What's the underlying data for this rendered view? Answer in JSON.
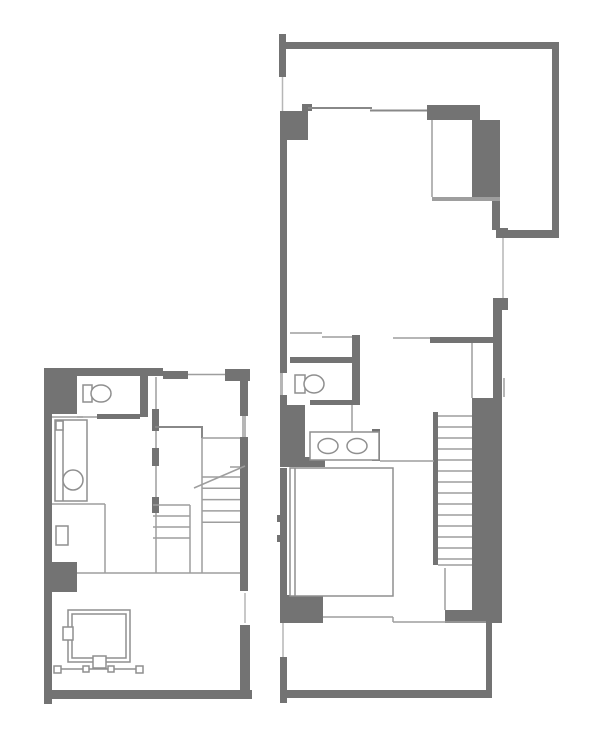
{
  "canvas": {
    "width": 600,
    "height": 746,
    "background": "#ffffff"
  },
  "palette": {
    "wall": "#737373",
    "line_dark": "#888888",
    "line": "#9e9e9e",
    "line_light": "#b6b6b6",
    "fixture": "#8f8f8f",
    "white": "#ffffff"
  },
  "plans": [
    {
      "name": "floor-plan-left",
      "shapes": [
        {
          "t": "r",
          "x": 44,
          "y": 368,
          "w": 119,
          "h": 8,
          "name": "wall-top"
        },
        {
          "t": "r",
          "x": 163,
          "y": 371,
          "w": 25,
          "h": 8,
          "name": "wall-top-step"
        },
        {
          "t": "r",
          "x": 225,
          "y": 369,
          "w": 25,
          "h": 12,
          "name": "wall-top-right-block"
        },
        {
          "t": "r",
          "x": 44,
          "y": 368,
          "w": 33,
          "h": 46,
          "name": "wall-left-block"
        },
        {
          "t": "r",
          "x": 44,
          "y": 414,
          "w": 8,
          "h": 148,
          "name": "wall-left"
        },
        {
          "t": "r",
          "x": 44,
          "y": 562,
          "w": 33,
          "h": 30,
          "name": "wall-left-pier"
        },
        {
          "t": "r",
          "x": 44,
          "y": 592,
          "w": 8,
          "h": 107,
          "name": "wall-left-lower"
        },
        {
          "t": "r",
          "x": 44,
          "y": 690,
          "w": 208,
          "h": 9,
          "name": "wall-bottom"
        },
        {
          "t": "r",
          "x": 44,
          "y": 699,
          "w": 8,
          "h": 5,
          "name": "wall-bottom-stub"
        },
        {
          "t": "r",
          "x": 240,
          "y": 381,
          "w": 8,
          "h": 35,
          "name": "wall-right-upper"
        },
        {
          "t": "r",
          "x": 242,
          "y": 416,
          "w": 4,
          "h": 21,
          "c": "line_light",
          "name": "window-right-upper"
        },
        {
          "t": "r",
          "x": 240,
          "y": 437,
          "w": 8,
          "h": 154,
          "name": "wall-right-mid"
        },
        {
          "t": "r",
          "x": 240,
          "y": 625,
          "w": 10,
          "h": 66,
          "name": "wall-right-lower"
        },
        {
          "t": "r",
          "x": 140,
          "y": 374,
          "w": 8,
          "h": 43,
          "name": "wall-toilet-right"
        },
        {
          "t": "r",
          "x": 97,
          "y": 414,
          "w": 43,
          "h": 5,
          "name": "wall-toilet-bottom"
        },
        {
          "t": "r",
          "x": 152,
          "y": 409,
          "w": 7,
          "h": 22,
          "name": "wall-middle-seg1"
        },
        {
          "t": "r",
          "x": 152,
          "y": 448,
          "w": 7,
          "h": 18,
          "name": "wall-middle-seg2"
        },
        {
          "t": "r",
          "x": 152,
          "y": 497,
          "w": 7,
          "h": 16,
          "name": "wall-middle-seg3"
        },
        {
          "t": "or",
          "x": 55,
          "y": 420,
          "w": 32,
          "h": 81,
          "name": "kitchen-counter"
        },
        {
          "t": "l",
          "x1": 63,
          "y1": 420,
          "x2": 63,
          "y2": 501,
          "c": "fixture",
          "name": "kitchen-counter-edge"
        },
        {
          "t": "or",
          "x": 56,
          "y": 421,
          "w": 7,
          "h": 9,
          "name": "faucet-box"
        },
        {
          "t": "c",
          "cx": 73,
          "cy": 480,
          "r": 10,
          "name": "kitchen-sink"
        },
        {
          "t": "or",
          "x": 56,
          "y": 526,
          "w": 12,
          "h": 19,
          "name": "side-box"
        },
        {
          "t": "or",
          "x": 83,
          "y": 385,
          "w": 9,
          "h": 17,
          "name": "toilet-tank"
        },
        {
          "t": "e",
          "cx": 101,
          "cy": 393.5,
          "rx": 10,
          "ry": 8.5,
          "name": "toilet-bowl"
        },
        {
          "t": "or",
          "x": 68,
          "y": 610,
          "w": 62,
          "h": 52,
          "name": "low-table-outer"
        },
        {
          "t": "or",
          "x": 72,
          "y": 614,
          "w": 54,
          "h": 44,
          "name": "low-table-inner"
        },
        {
          "t": "or",
          "x": 63,
          "y": 627,
          "w": 10,
          "h": 13,
          "name": "side-attachment-box"
        },
        {
          "t": "or",
          "x": 93,
          "y": 656,
          "w": 13,
          "h": 12,
          "name": "bottom-attachment-box"
        },
        {
          "t": "l",
          "x1": 57,
          "y1": 669,
          "x2": 140,
          "y2": 669,
          "c": "fixture",
          "name": "rail-line"
        },
        {
          "t": "or",
          "x": 54,
          "y": 666,
          "w": 7,
          "h": 7,
          "name": "rail-post"
        },
        {
          "t": "or",
          "x": 83,
          "y": 666,
          "w": 6,
          "h": 6,
          "name": "rail-post"
        },
        {
          "t": "or",
          "x": 108,
          "y": 666,
          "w": 6,
          "h": 6,
          "name": "rail-post"
        },
        {
          "t": "or",
          "x": 136,
          "y": 666,
          "w": 7,
          "h": 7,
          "name": "rail-post"
        },
        {
          "t": "l",
          "x1": 188,
          "y1": 374.5,
          "x2": 225,
          "y2": 374.5,
          "name": "window-top"
        },
        {
          "t": "l",
          "x1": 77,
          "y1": 417,
          "x2": 97,
          "y2": 417,
          "name": "toilet-door-line"
        },
        {
          "t": "l",
          "x1": 52,
          "y1": 417,
          "x2": 83,
          "y2": 417,
          "name": "counter-top-line"
        },
        {
          "t": "l",
          "x1": 156,
          "y1": 377,
          "x2": 156,
          "y2": 409,
          "name": "partition-line"
        },
        {
          "t": "l",
          "x1": 156,
          "y1": 431,
          "x2": 156,
          "y2": 448,
          "name": "partition-line"
        },
        {
          "t": "l",
          "x1": 156,
          "y1": 466,
          "x2": 156,
          "y2": 497,
          "name": "partition-line"
        },
        {
          "t": "l",
          "x1": 156,
          "y1": 513,
          "x2": 156,
          "y2": 573,
          "name": "partition-line"
        },
        {
          "t": "l",
          "x1": 155,
          "y1": 427,
          "x2": 203,
          "y2": 427,
          "sw": 2,
          "c": "line_dark",
          "name": "hall-partition"
        },
        {
          "t": "l",
          "x1": 202,
          "y1": 427,
          "x2": 202,
          "y2": 438,
          "sw": 2,
          "c": "line_dark",
          "name": "hall-partition"
        },
        {
          "t": "l",
          "x1": 202,
          "y1": 438,
          "x2": 240,
          "y2": 438,
          "name": "hall-partition-light"
        },
        {
          "t": "l",
          "x1": 52,
          "y1": 504,
          "x2": 105,
          "y2": 504,
          "name": "kitchen-floor-line"
        },
        {
          "t": "l",
          "x1": 105,
          "y1": 504,
          "x2": 105,
          "y2": 573,
          "name": "kitchen-floor-line"
        },
        {
          "t": "l",
          "x1": 77,
          "y1": 573,
          "x2": 240,
          "y2": 573,
          "name": "room-divider-line"
        },
        {
          "t": "l",
          "x1": 245,
          "y1": 593,
          "x2": 245,
          "y2": 623,
          "c": "line_light",
          "name": "window-right-lower"
        },
        {
          "t": "l",
          "x1": 190,
          "y1": 505,
          "x2": 190,
          "y2": 573,
          "name": "stair-stringer"
        },
        {
          "t": "l",
          "x1": 202,
          "y1": 438,
          "x2": 202,
          "y2": 573,
          "name": "stair-stringer"
        },
        {
          "t": "tr",
          "x1": 153,
          "x2": 190,
          "y0": 505,
          "step": 11,
          "n": 4,
          "name": "stair-treads"
        },
        {
          "t": "tr",
          "x1": 202,
          "x2": 240,
          "y0": 477,
          "step": 11.3,
          "n": 5,
          "name": "stair-treads"
        },
        {
          "t": "l",
          "x1": 230,
          "y1": 467,
          "x2": 240,
          "y2": 467,
          "name": "stair-tread-partial"
        },
        {
          "t": "l",
          "x1": 194,
          "y1": 488,
          "x2": 245,
          "y2": 466,
          "name": "stair-break-line"
        }
      ]
    },
    {
      "name": "floor-plan-right",
      "shapes": [
        {
          "t": "r",
          "x": 279,
          "y": 34,
          "w": 7,
          "h": 43,
          "name": "wall-top-left-stub"
        },
        {
          "t": "r",
          "x": 286,
          "y": 42,
          "w": 273,
          "h": 7,
          "name": "wall-top"
        },
        {
          "t": "r",
          "x": 552,
          "y": 49,
          "w": 7,
          "h": 189,
          "name": "wall-right"
        },
        {
          "t": "r",
          "x": 508,
          "y": 230,
          "w": 51,
          "h": 8,
          "name": "wall-right-return"
        },
        {
          "t": "r",
          "x": 496,
          "y": 228,
          "w": 12,
          "h": 10,
          "name": "wall-stub"
        },
        {
          "t": "r",
          "x": 427,
          "y": 105,
          "w": 53,
          "h": 15,
          "name": "closet-top-wall"
        },
        {
          "t": "r",
          "x": 472,
          "y": 120,
          "w": 28,
          "h": 81,
          "name": "closet-right-wall"
        },
        {
          "t": "r",
          "x": 492,
          "y": 201,
          "w": 8,
          "h": 29,
          "name": "wall-column"
        },
        {
          "t": "r",
          "x": 302,
          "y": 104,
          "w": 10,
          "h": 7,
          "name": "wall-stub"
        },
        {
          "t": "r",
          "x": 280,
          "y": 111,
          "w": 28,
          "h": 29,
          "name": "wall-left-block"
        },
        {
          "t": "r",
          "x": 280,
          "y": 140,
          "w": 7,
          "h": 233,
          "name": "wall-left"
        },
        {
          "t": "r",
          "x": 280,
          "y": 373,
          "w": 3,
          "h": 22,
          "c": "line_light",
          "name": "window-left"
        },
        {
          "t": "r",
          "x": 280,
          "y": 395,
          "w": 7,
          "h": 10,
          "name": "wall-left"
        },
        {
          "t": "r",
          "x": 280,
          "y": 405,
          "w": 25,
          "h": 53,
          "name": "wall-left-pier"
        },
        {
          "t": "r",
          "x": 280,
          "y": 457,
          "w": 45,
          "h": 10,
          "name": "wall-stub-under-vanity"
        },
        {
          "t": "r",
          "x": 280,
          "y": 468,
          "w": 7,
          "h": 127,
          "name": "wall-left-lower"
        },
        {
          "t": "r",
          "x": 277,
          "y": 515,
          "w": 3,
          "h": 7,
          "name": "window-tick"
        },
        {
          "t": "r",
          "x": 277,
          "y": 535,
          "w": 3,
          "h": 7,
          "name": "window-tick"
        },
        {
          "t": "r",
          "x": 280,
          "y": 595,
          "w": 43,
          "h": 28,
          "name": "wall-bottom-left-pier"
        },
        {
          "t": "r",
          "x": 280,
          "y": 657,
          "w": 7,
          "h": 43,
          "name": "balcony-left-wall"
        },
        {
          "t": "r",
          "x": 282,
          "y": 690,
          "w": 210,
          "h": 8,
          "name": "balcony-bottom-wall"
        },
        {
          "t": "r",
          "x": 280,
          "y": 690,
          "w": 7,
          "h": 13,
          "name": "balcony-corner-stub"
        },
        {
          "t": "r",
          "x": 486,
          "y": 623,
          "w": 6,
          "h": 75,
          "name": "balcony-right-wall"
        },
        {
          "t": "r",
          "x": 290,
          "y": 357,
          "w": 62,
          "h": 6,
          "name": "toilet-top-wall"
        },
        {
          "t": "r",
          "x": 352,
          "y": 335,
          "w": 8,
          "h": 67,
          "name": "toilet-side-wall"
        },
        {
          "t": "r",
          "x": 310,
          "y": 400,
          "w": 50,
          "h": 5,
          "name": "toilet-bottom-wall"
        },
        {
          "t": "r",
          "x": 430,
          "y": 337,
          "w": 63,
          "h": 6,
          "name": "hall-wall"
        },
        {
          "t": "r",
          "x": 493,
          "y": 298,
          "w": 15,
          "h": 12,
          "name": "wall-pier"
        },
        {
          "t": "r",
          "x": 493,
          "y": 310,
          "w": 9,
          "h": 313,
          "name": "wall-right-lower"
        },
        {
          "t": "r",
          "x": 472,
          "y": 398,
          "w": 21,
          "h": 225,
          "name": "stair-right-wall"
        },
        {
          "t": "r",
          "x": 445,
          "y": 610,
          "w": 27,
          "h": 13,
          "name": "stair-bottom-block"
        },
        {
          "t": "r",
          "x": 433,
          "y": 412,
          "w": 5,
          "h": 153,
          "name": "stair-left-rail"
        },
        {
          "t": "r",
          "x": 372,
          "y": 429,
          "w": 8,
          "h": 32,
          "name": "vanity-side-wall"
        },
        {
          "t": "r",
          "x": 432,
          "y": 197,
          "w": 68,
          "h": 4,
          "c": "line",
          "name": "closet-bottom-bar"
        },
        {
          "t": "or",
          "x": 295,
          "y": 375,
          "w": 10,
          "h": 18,
          "name": "toilet-tank"
        },
        {
          "t": "e",
          "cx": 314,
          "cy": 384,
          "rx": 10,
          "ry": 9,
          "name": "toilet-bowl"
        },
        {
          "t": "or",
          "x": 310,
          "y": 432,
          "w": 69,
          "h": 28,
          "name": "washbasin-counter"
        },
        {
          "t": "e",
          "cx": 328,
          "cy": 446,
          "rx": 10,
          "ry": 7.5,
          "name": "washbasin-left"
        },
        {
          "t": "e",
          "cx": 357,
          "cy": 446,
          "rx": 10,
          "ry": 7.5,
          "name": "washbasin-right"
        },
        {
          "t": "or",
          "x": 290,
          "y": 468,
          "w": 103,
          "h": 128,
          "name": "double-bed"
        },
        {
          "t": "l",
          "x1": 295,
          "y1": 468,
          "x2": 295,
          "y2": 596,
          "c": "fixture",
          "name": "bed-head-line"
        },
        {
          "t": "l",
          "x1": 282.5,
          "y1": 77,
          "x2": 282.5,
          "y2": 111,
          "c": "line_light",
          "name": "window-left-top"
        },
        {
          "t": "l",
          "x1": 308,
          "y1": 108,
          "x2": 372,
          "y2": 108,
          "sw": 2,
          "c": "line_dark",
          "name": "partition-line"
        },
        {
          "t": "l",
          "x1": 370,
          "y1": 110.5,
          "x2": 427,
          "y2": 110.5,
          "sw": 2,
          "c": "line_dark",
          "name": "partition-line"
        },
        {
          "t": "l",
          "x1": 432,
          "y1": 120,
          "x2": 432,
          "y2": 197,
          "name": "closet-left-edge"
        },
        {
          "t": "l",
          "x1": 503,
          "y1": 238,
          "x2": 503,
          "y2": 298,
          "c": "line_light",
          "name": "window-right"
        },
        {
          "t": "l",
          "x1": 504,
          "y1": 378,
          "x2": 504,
          "y2": 397,
          "sw": 2,
          "c": "line_light",
          "name": "window-right-lower"
        },
        {
          "t": "l",
          "x1": 290,
          "y1": 333,
          "x2": 322,
          "y2": 333,
          "name": "sliding-door-line"
        },
        {
          "t": "l",
          "x1": 322,
          "y1": 337,
          "x2": 352,
          "y2": 337,
          "name": "sliding-door-line"
        },
        {
          "t": "l",
          "x1": 393,
          "y1": 338,
          "x2": 430,
          "y2": 338,
          "name": "sliding-door-line"
        },
        {
          "t": "l",
          "x1": 472,
          "y1": 343,
          "x2": 472,
          "y2": 398,
          "name": "closet2-left-edge"
        },
        {
          "t": "l",
          "x1": 352,
          "y1": 405,
          "x2": 352,
          "y2": 432,
          "name": "washroom-line"
        },
        {
          "t": "l",
          "x1": 380,
          "y1": 461,
          "x2": 434,
          "y2": 461,
          "name": "bedroom-divider-line"
        },
        {
          "t": "l",
          "x1": 438,
          "y1": 565,
          "x2": 472,
          "y2": 565,
          "name": "stair-bottom-line"
        },
        {
          "t": "l",
          "x1": 445,
          "y1": 568,
          "x2": 445,
          "y2": 610,
          "name": "stair-landing-line"
        },
        {
          "t": "l",
          "x1": 323,
          "y1": 617,
          "x2": 393,
          "y2": 617,
          "name": "balcony-edge-line"
        },
        {
          "t": "l",
          "x1": 393,
          "y1": 617,
          "x2": 393,
          "y2": 622,
          "name": "balcony-edge-line"
        },
        {
          "t": "l",
          "x1": 393,
          "y1": 622,
          "x2": 486,
          "y2": 622,
          "name": "balcony-edge-line"
        },
        {
          "t": "l",
          "x1": 283,
          "y1": 623,
          "x2": 283,
          "y2": 657,
          "c": "line_light",
          "name": "balcony-left-line"
        },
        {
          "t": "tr",
          "x1": 438,
          "x2": 472,
          "y0": 416,
          "step": 11,
          "n": 14,
          "name": "stair-treads"
        }
      ]
    }
  ]
}
